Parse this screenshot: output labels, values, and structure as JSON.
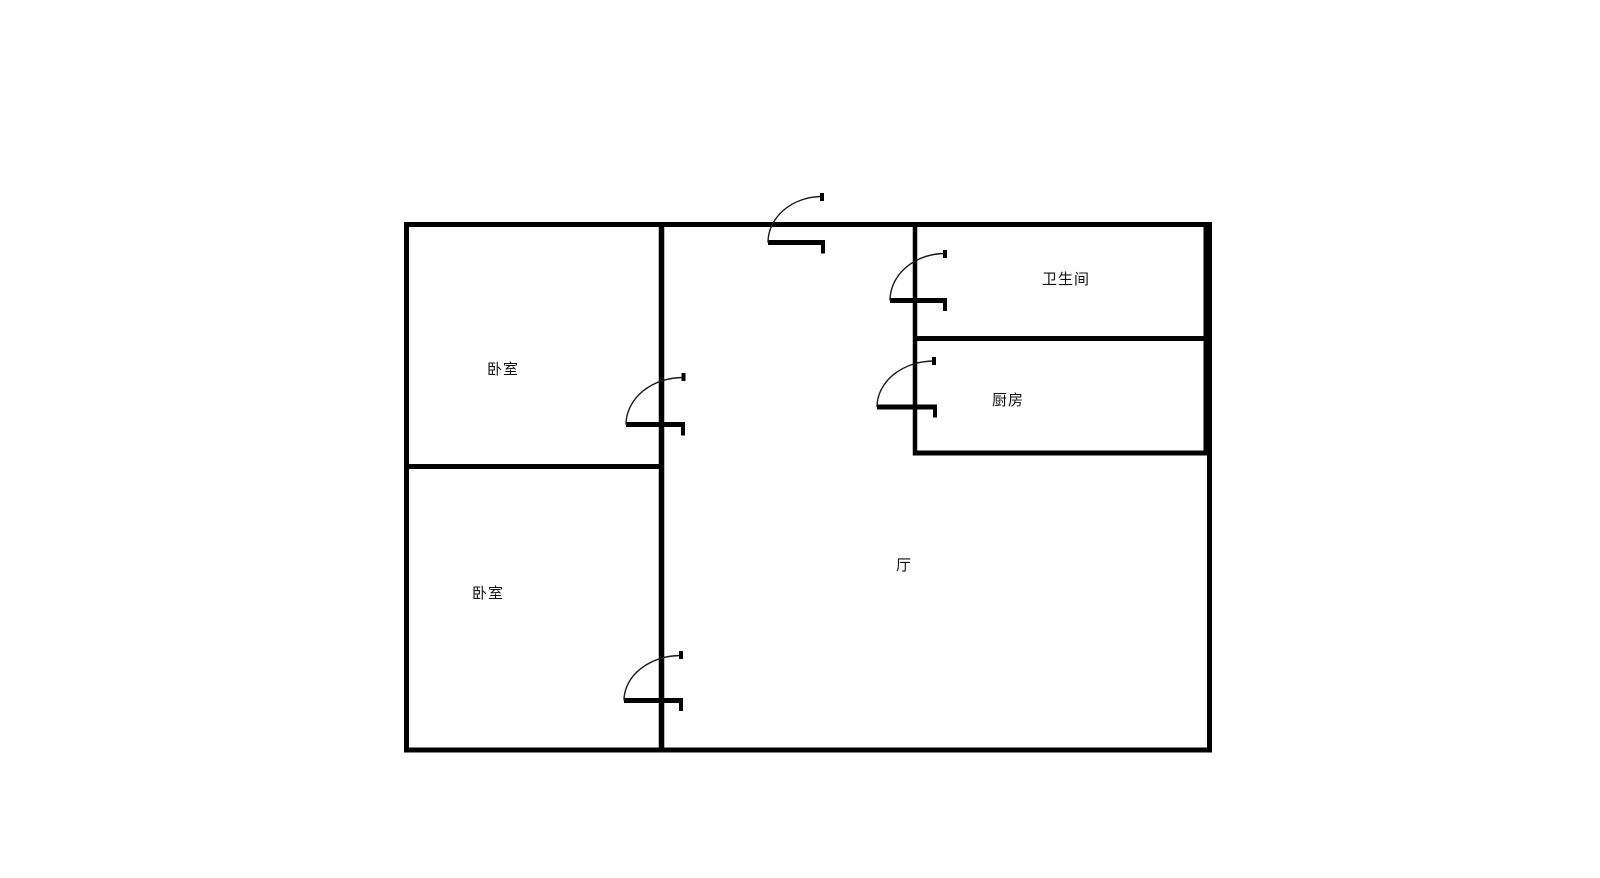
{
  "colors": {
    "wall": "#000000",
    "background": "#ffffff",
    "text": "#111111"
  },
  "floor_plan": {
    "rooms": [
      {
        "name": "bedroom-top",
        "label": "卧室"
      },
      {
        "name": "bedroom-bottom",
        "label": "卧室"
      },
      {
        "name": "bathroom",
        "label": "卫生间"
      },
      {
        "name": "kitchen",
        "label": "厨房"
      },
      {
        "name": "hall",
        "label": "厅"
      }
    ]
  }
}
